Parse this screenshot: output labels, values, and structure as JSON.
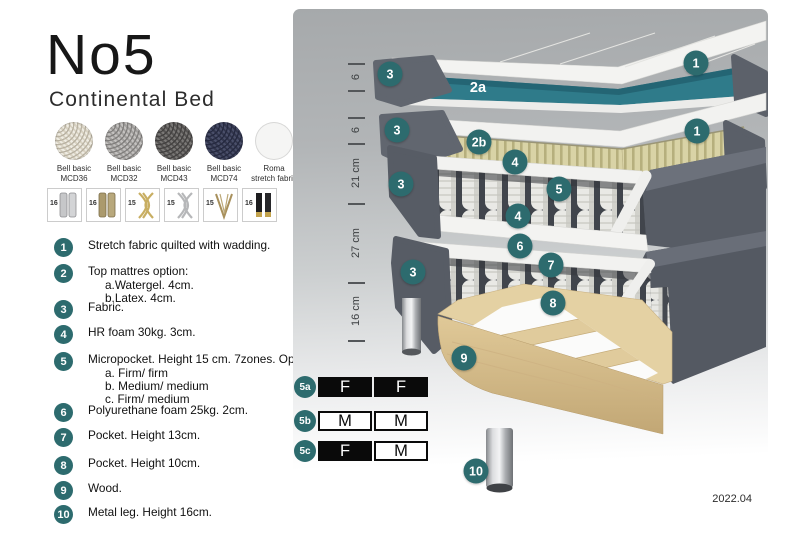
{
  "page": {
    "title": "No5",
    "subtitle": "Continental Bed",
    "version": "2022.04"
  },
  "colors": {
    "badge_teal": "#2d6b6e",
    "layer_teal": "#2f7b8a",
    "corrugation_beige": "#d9d3a6",
    "mattress_gray": "#575c65",
    "wood": "#e0c998",
    "table_black": "#0a0a0a"
  },
  "fabric_swatches": [
    {
      "line1": "Bell basic",
      "line2": "MCD36",
      "style": "weave-beige"
    },
    {
      "line1": "Bell basic",
      "line2": "MCD32",
      "style": "weave-gray"
    },
    {
      "line1": "Bell basic",
      "line2": "MCD43",
      "style": "weave-darkgray"
    },
    {
      "line1": "Bell basic",
      "line2": "MCD74",
      "style": "weave-navy"
    },
    {
      "line1": "Roma",
      "line2": "stretch fabric",
      "style": "plain-white"
    }
  ],
  "leg_options": [
    {
      "height": "16",
      "style": "cylinder-silver"
    },
    {
      "height": "16",
      "style": "cylinder-brass"
    },
    {
      "height": "15",
      "style": "cross-gold"
    },
    {
      "height": "15",
      "style": "cross-silver"
    },
    {
      "height": "15",
      "style": "hairpin-gold"
    },
    {
      "height": "16",
      "style": "cylinder-black-gold"
    }
  ],
  "parts": [
    {
      "num": "1",
      "text": "Stretch fabric quilted with wadding.",
      "sub": []
    },
    {
      "num": "2",
      "text": "Top mattres option:",
      "sub": [
        "a.Watergel. 4cm.",
        "b.Latex. 4cm."
      ]
    },
    {
      "num": "3",
      "text": "Fabric.",
      "sub": []
    },
    {
      "num": "4",
      "text": "HR foam 30kg. 3cm.",
      "sub": []
    },
    {
      "num": "5",
      "text": "Micropocket. Height 15 cm. 7zones. Option:",
      "sub": [
        "a. Firm/ firm",
        "b. Medium/ medium",
        "c. Firm/ medium"
      ]
    },
    {
      "num": "6",
      "text": "Polyurethane foam 25kg. 2cm.",
      "sub": []
    },
    {
      "num": "7",
      "text": "Pocket. Height 13cm.",
      "sub": []
    },
    {
      "num": "8",
      "text": "Pocket. Height 10cm.",
      "sub": []
    },
    {
      "num": "9",
      "text": "Wood.",
      "sub": []
    },
    {
      "num": "10",
      "text": "Metal leg. Height 16cm.",
      "sub": []
    }
  ],
  "diagram": {
    "measurements": [
      {
        "label": "6"
      },
      {
        "label": "6"
      },
      {
        "label": "21 cm"
      },
      {
        "label": "27 cm"
      },
      {
        "label": "16 cm"
      }
    ],
    "callouts": [
      {
        "n": "3",
        "x": 390,
        "y": 74
      },
      {
        "n": "1",
        "x": 696,
        "y": 63
      },
      {
        "n": "2a",
        "x": 478,
        "y": 88,
        "plain": true
      },
      {
        "n": "3",
        "x": 397,
        "y": 130
      },
      {
        "n": "1",
        "x": 697,
        "y": 131
      },
      {
        "n": "2b",
        "x": 479,
        "y": 142
      },
      {
        "n": "4",
        "x": 515,
        "y": 162
      },
      {
        "n": "3",
        "x": 401,
        "y": 184
      },
      {
        "n": "5",
        "x": 559,
        "y": 189
      },
      {
        "n": "4",
        "x": 518,
        "y": 216
      },
      {
        "n": "6",
        "x": 520,
        "y": 246
      },
      {
        "n": "7",
        "x": 551,
        "y": 265
      },
      {
        "n": "3",
        "x": 413,
        "y": 272
      },
      {
        "n": "8",
        "x": 553,
        "y": 303
      },
      {
        "n": "9",
        "x": 464,
        "y": 358
      },
      {
        "n": "10",
        "x": 476,
        "y": 471
      }
    ],
    "firmness_table": [
      {
        "label": "5a",
        "cells": [
          {
            "letter": "F",
            "variant": "dark"
          },
          {
            "letter": "F",
            "variant": "dark"
          }
        ]
      },
      {
        "label": "5b",
        "cells": [
          {
            "letter": "M",
            "variant": "light"
          },
          {
            "letter": "M",
            "variant": "light"
          }
        ]
      },
      {
        "label": "5c",
        "cells": [
          {
            "letter": "F",
            "variant": "dark"
          },
          {
            "letter": "M",
            "variant": "light"
          }
        ]
      }
    ]
  }
}
